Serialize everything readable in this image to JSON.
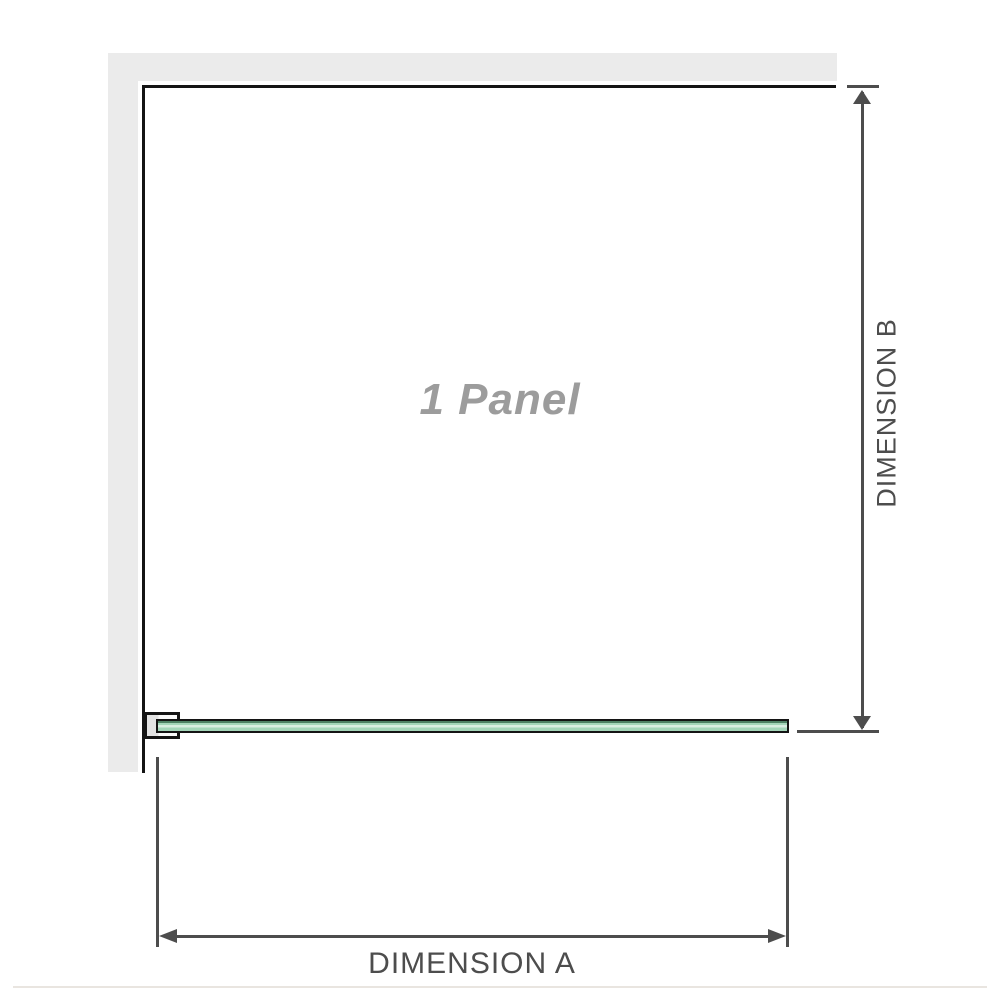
{
  "labels": {
    "panel": "1 Panel",
    "dimension_a": "DIMENSION A",
    "dimension_b": "DIMENSION B"
  },
  "colors": {
    "wall": "#ebebeb",
    "outline": "#141414",
    "dimension": "#4d4d4d",
    "panel_text": "#9c9c9c",
    "glass_green": "#a4d5b9",
    "glass_highlight": "#d9ede1",
    "glass_shadow": "#4e8064",
    "bracket_fill": "#e3e3e3",
    "baseline": "#e9e5e0"
  }
}
